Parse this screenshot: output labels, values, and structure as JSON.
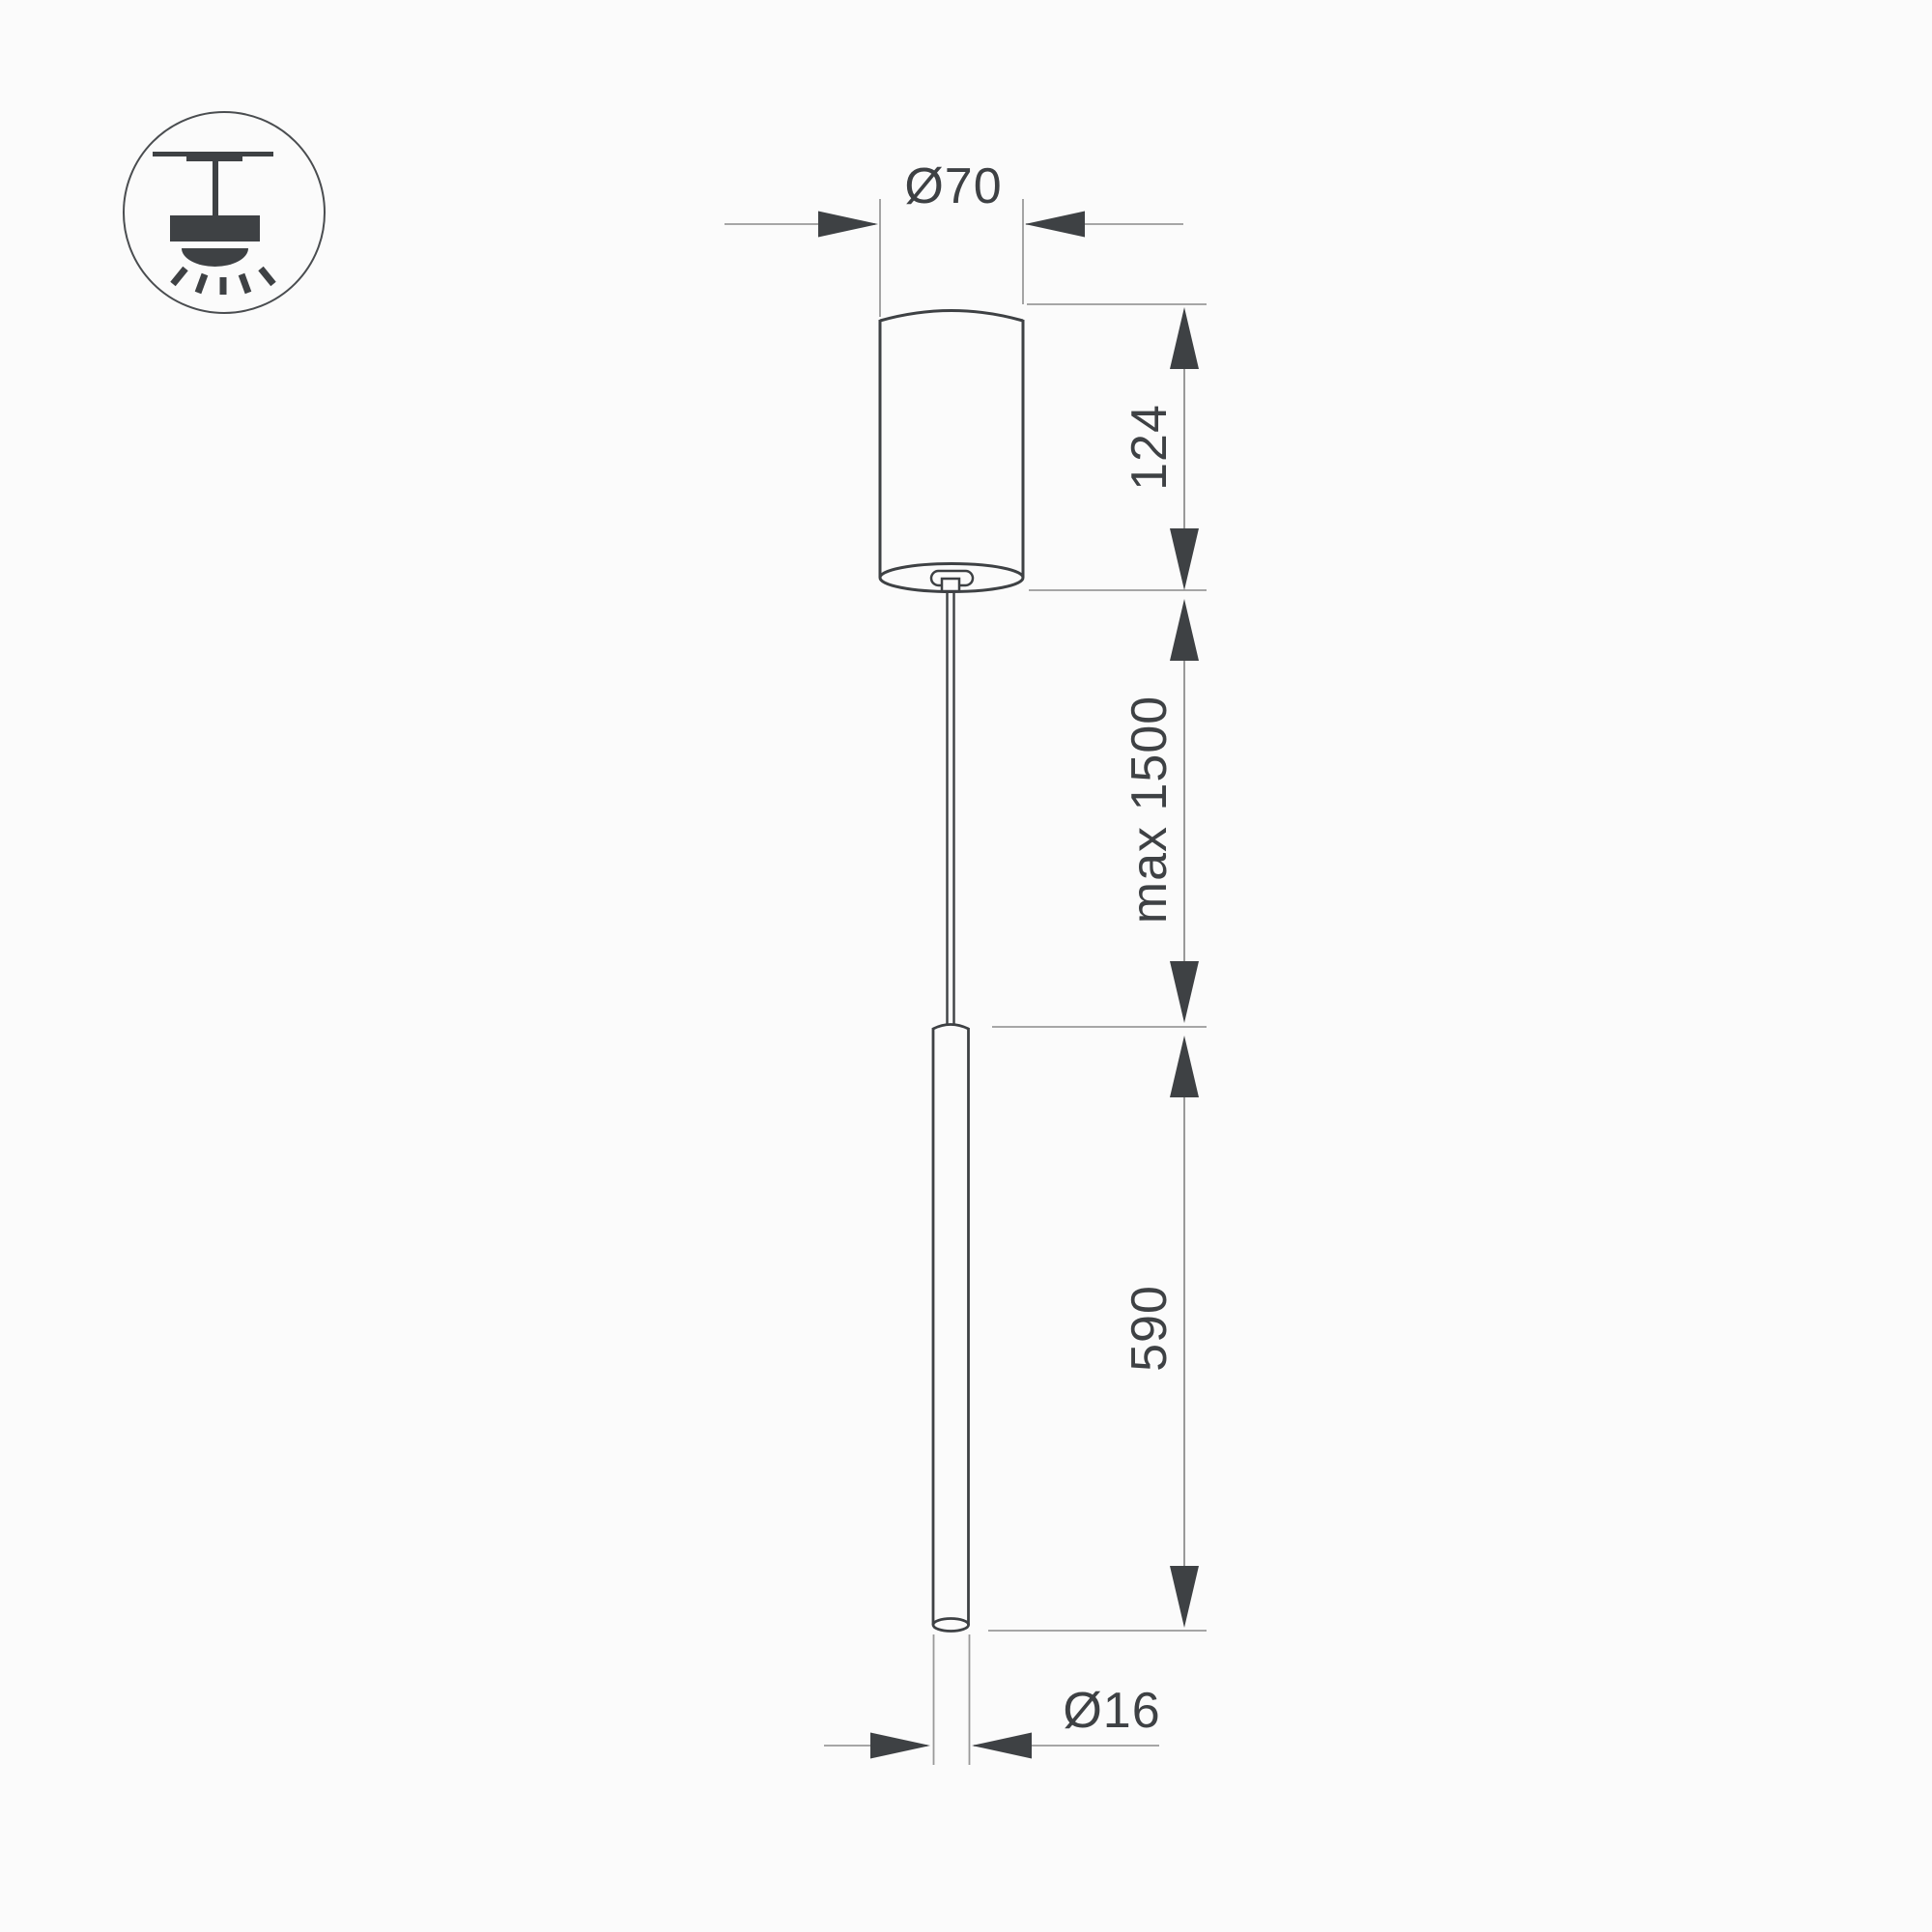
{
  "drawing": {
    "kind": "pendant-luminaire-dimension-drawing",
    "background_color": "#fbfbfb",
    "object_line_color": "#3e4144",
    "dimension_line_color": "#9a9a9a",
    "arrow_color": "#3e4144",
    "text_color": "#3e4144",
    "icon": "ceiling-pendant-mount-icon",
    "dimensions": {
      "canopy_diameter": "Ø70",
      "canopy_height": "124",
      "suspension_length": "max 1500",
      "tube_length": "590",
      "tube_diameter": "Ø16"
    }
  }
}
